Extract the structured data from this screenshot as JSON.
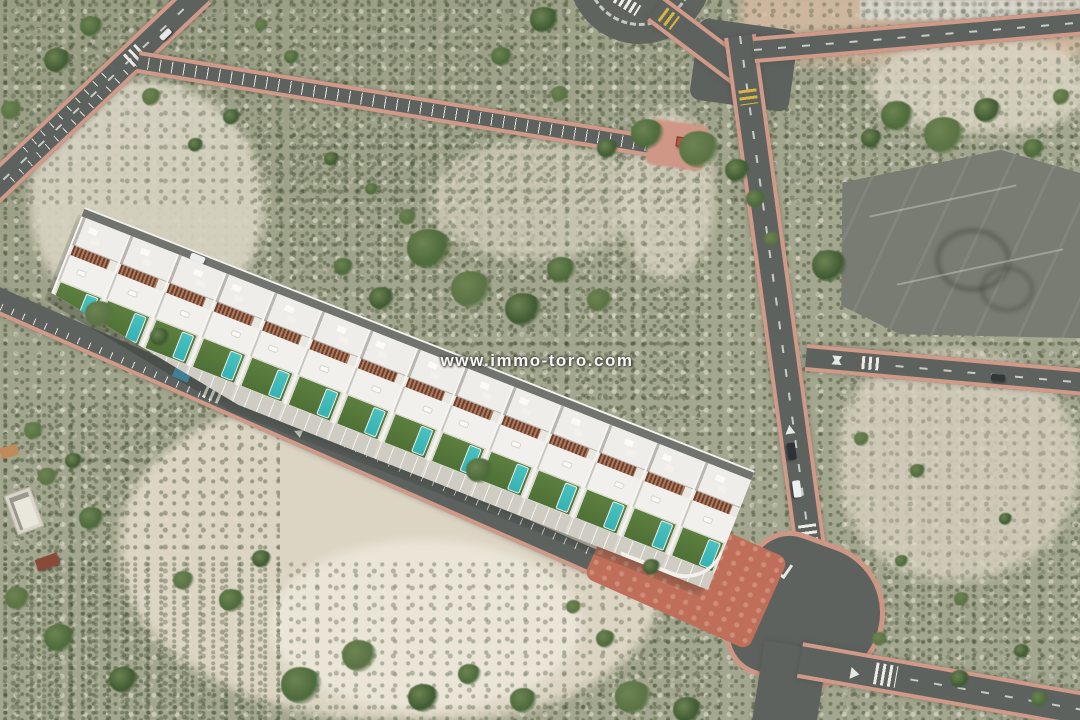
{
  "scene": {
    "type": "aerial-drone-photo",
    "subject": "row of new-build white terraced villas with private pools beside asphalt roads on semi-arid scrubland"
  },
  "watermark": {
    "text": "www.immo-toro.com"
  },
  "development": {
    "unit_count": 14,
    "roof_color": "#efede9",
    "lawn_color": "#5d8040",
    "pool_color": "#35b2b4",
    "pergola_color": "#6e3f2c",
    "wall_color": "#f5f3ef",
    "apron_color": "#cfccc3"
  },
  "palette": {
    "asphalt": "#5e625f",
    "sidewalk_pink": "#d09a89",
    "terracotta_plaza": "#bf6f59",
    "plaza_gray": "#797c73",
    "scrub_green": "#55663f",
    "sand": "#ddd5c4",
    "dirt_tan": "#ccb69e",
    "marking_white": "#edebe5",
    "marking_yellow": "#d9b53e"
  },
  "vehicles": {
    "white_cars": 3,
    "dark_cars": 2
  }
}
